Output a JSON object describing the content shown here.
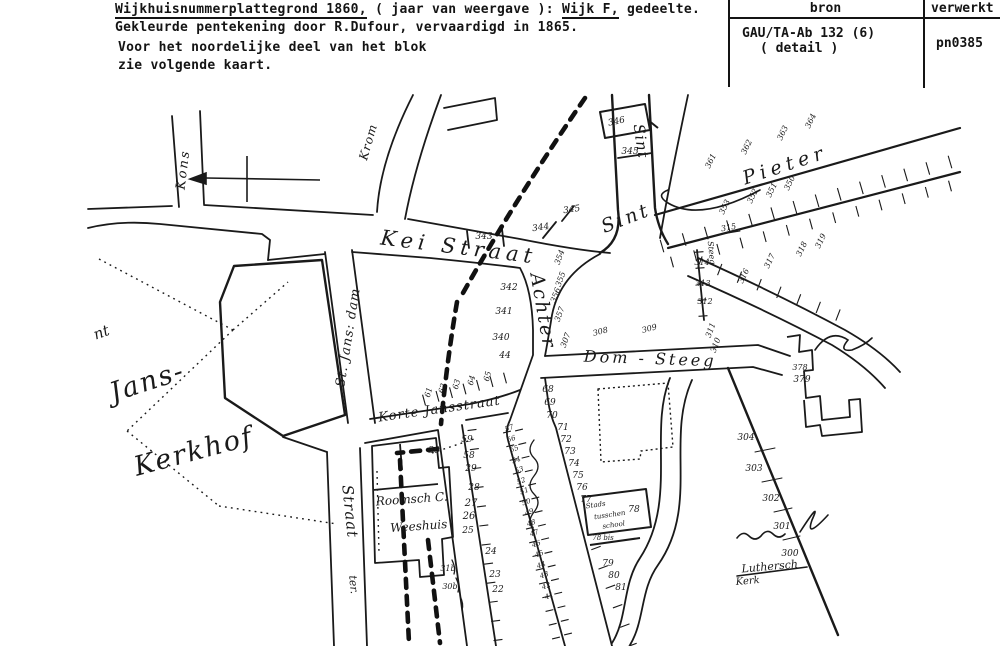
{
  "document": {
    "line1_part1": "Wijkhuisnummerplattegrond 1860,",
    "line1_part2": " ( jaar van weergave ): ",
    "line1_part3": "Wijk F,",
    "line1_part4": " gedeelte.",
    "line2": "Gekleurde pentekening door R.Dufour, vervaardigd in 1865.",
    "line3": "Voor het noordelijke deel van het blok",
    "line4": "zie volgende kaart.",
    "table": {
      "col1_header": "bron",
      "col2_header": "verwerkt",
      "source_line1": "GAU/TA-Ab 132 (6)",
      "source_line2": "( detail )",
      "processed_code": "pn0385"
    }
  },
  "colors": {
    "ink": "#141414",
    "paper": "#ffffff"
  },
  "map": {
    "compass": {
      "points": "west"
    },
    "labels": [
      {
        "n": "street-label-kons",
        "t": "Kons",
        "x": 187,
        "y": 170,
        "r": -83,
        "s": 13,
        "sp": 2,
        "st": "script"
      },
      {
        "n": "street-label-krom",
        "t": "Krom",
        "x": 372,
        "y": 143,
        "r": -74,
        "s": 12,
        "sp": 1,
        "st": "script"
      },
      {
        "n": "street-label-kei-straat",
        "t": "Kei Straat",
        "x": 458,
        "y": 254,
        "r": 7,
        "s": 21,
        "sp": 5,
        "st": "script"
      },
      {
        "n": "street-label-achter",
        "t": "Achter",
        "x": 537,
        "y": 312,
        "r": 80,
        "s": 19,
        "sp": 2,
        "st": "script"
      },
      {
        "n": "street-label-sint",
        "t": "Sint",
        "x": 628,
        "y": 224,
        "r": -21,
        "s": 19,
        "sp": 3,
        "st": "script"
      },
      {
        "n": "street-label-pieter",
        "t": "Pieter",
        "x": 787,
        "y": 171,
        "r": -18,
        "s": 19,
        "sp": 5,
        "st": "script"
      },
      {
        "n": "street-label-sint-vertical",
        "t": "Sint",
        "x": 636,
        "y": 142,
        "r": 82,
        "s": 15,
        "sp": 1,
        "st": "script"
      },
      {
        "n": "street-label-dom-steeg",
        "t": "Dom - Steeg",
        "x": 650,
        "y": 364,
        "r": 2,
        "s": 16,
        "sp": 3,
        "st": "script"
      },
      {
        "n": "street-label-st-jans-dam",
        "t": "St. Jans: dam",
        "x": 352,
        "y": 338,
        "r": -81,
        "s": 13,
        "sp": 1,
        "st": "script"
      },
      {
        "n": "street-label-korte-jansstraat",
        "t": "Korte Jansstraat",
        "x": 440,
        "y": 413,
        "r": -8,
        "s": 13,
        "sp": 1,
        "st": "script"
      },
      {
        "n": "place-label-jans",
        "t": "Jans-",
        "x": 150,
        "y": 390,
        "r": -18,
        "s": 27,
        "sp": 2,
        "st": "script"
      },
      {
        "n": "place-label-kerkhof",
        "t": "Kerkhof",
        "x": 196,
        "y": 460,
        "r": -15,
        "s": 27,
        "sp": 2,
        "st": "script"
      },
      {
        "n": "place-label-fragment-nt",
        "t": "nt",
        "x": 103,
        "y": 337,
        "r": -20,
        "s": 15,
        "st": "script"
      },
      {
        "n": "street-label-straat-vertical",
        "t": "Straat",
        "x": 345,
        "y": 512,
        "r": 84,
        "s": 15,
        "sp": 1,
        "st": "script"
      },
      {
        "n": "street-label-ter",
        "t": "ter.",
        "x": 350,
        "y": 585,
        "r": 84,
        "s": 11,
        "st": "script"
      },
      {
        "n": "street-label-steeg-small",
        "t": "Steeg",
        "x": 709,
        "y": 253,
        "r": 84,
        "s": 8,
        "st": "script"
      },
      {
        "n": "place-label-roomsch-c",
        "t": "Roomsch C.",
        "x": 412,
        "y": 503,
        "r": -4,
        "s": 12,
        "st": "script"
      },
      {
        "n": "place-label-weeshuis",
        "t": "Weeshuis",
        "x": 419,
        "y": 530,
        "r": -4,
        "s": 12,
        "st": "script"
      },
      {
        "n": "place-label-stads",
        "t": "Stads",
        "x": 596,
        "y": 507,
        "r": -8,
        "s": 7,
        "st": "script"
      },
      {
        "n": "place-label-tusschen",
        "t": "tusschen",
        "x": 610,
        "y": 517,
        "r": -8,
        "s": 7,
        "st": "script"
      },
      {
        "n": "place-label-school",
        "t": "school",
        "x": 614,
        "y": 527,
        "r": -8,
        "s": 7,
        "st": "script"
      },
      {
        "n": "place-label-luthersch",
        "t": "Luthersch",
        "x": 770,
        "y": 570,
        "r": -5,
        "s": 11,
        "st": "script"
      },
      {
        "n": "place-label-kerk",
        "t": "Kerk",
        "x": 748,
        "y": 584,
        "r": -5,
        "s": 10,
        "st": "script"
      },
      {
        "n": "plot-number",
        "t": "346",
        "x": 617,
        "y": 124,
        "r": -12
      },
      {
        "n": "plot-number",
        "t": "345",
        "x": 630,
        "y": 154
      },
      {
        "n": "plot-number",
        "t": "345",
        "x": 572,
        "y": 212,
        "r": -8
      },
      {
        "n": "plot-number",
        "t": "344",
        "x": 541,
        "y": 230,
        "r": -8
      },
      {
        "n": "plot-number",
        "t": "343",
        "x": 484,
        "y": 239
      },
      {
        "n": "plot-number",
        "t": "342",
        "x": 509,
        "y": 290
      },
      {
        "n": "plot-number",
        "t": "341",
        "x": 504,
        "y": 314
      },
      {
        "n": "plot-number",
        "t": "340",
        "x": 501,
        "y": 340
      },
      {
        "n": "plot-number",
        "t": "44",
        "x": 505,
        "y": 358
      },
      {
        "n": "plot-number",
        "t": "354",
        "x": 562,
        "y": 258,
        "r": -70,
        "s": 8
      },
      {
        "n": "plot-number",
        "t": "355",
        "x": 563,
        "y": 280,
        "r": -70,
        "s": 8
      },
      {
        "n": "plot-number",
        "t": "356",
        "x": 558,
        "y": 296,
        "r": -70,
        "s": 8
      },
      {
        "n": "plot-number",
        "t": "357",
        "x": 562,
        "y": 315,
        "r": -70,
        "s": 8
      },
      {
        "n": "plot-number",
        "t": "307",
        "x": 568,
        "y": 341,
        "r": -70,
        "s": 8
      },
      {
        "n": "plot-number",
        "t": "308",
        "x": 601,
        "y": 334,
        "r": -15,
        "s": 8
      },
      {
        "n": "plot-number",
        "t": "309",
        "x": 650,
        "y": 331,
        "r": -15,
        "s": 8
      },
      {
        "n": "plot-number",
        "t": "311",
        "x": 713,
        "y": 331,
        "r": -70,
        "s": 8
      },
      {
        "n": "plot-number",
        "t": "310",
        "x": 718,
        "y": 346,
        "r": -70,
        "s": 8
      },
      {
        "n": "plot-number",
        "t": "314",
        "x": 702,
        "y": 265,
        "s": 8
      },
      {
        "n": "plot-number",
        "t": "313",
        "x": 703,
        "y": 286,
        "s": 8
      },
      {
        "n": "plot-number",
        "t": "312",
        "x": 705,
        "y": 304,
        "s": 8
      },
      {
        "n": "plot-number",
        "t": "361",
        "x": 713,
        "y": 162,
        "r": -65,
        "s": 8
      },
      {
        "n": "plot-number",
        "t": "362",
        "x": 749,
        "y": 148,
        "r": -65,
        "s": 8
      },
      {
        "n": "plot-number",
        "t": "363",
        "x": 785,
        "y": 134,
        "r": -65,
        "s": 8
      },
      {
        "n": "plot-number",
        "t": "364",
        "x": 813,
        "y": 122,
        "r": -65,
        "s": 8
      },
      {
        "n": "plot-number",
        "t": "353",
        "x": 727,
        "y": 208,
        "r": -65,
        "s": 8
      },
      {
        "n": "plot-number",
        "t": "352",
        "x": 755,
        "y": 197,
        "r": -65,
        "s": 8
      },
      {
        "n": "plot-number",
        "t": "351",
        "x": 774,
        "y": 191,
        "r": -65,
        "s": 8
      },
      {
        "n": "plot-number",
        "t": "350",
        "x": 792,
        "y": 184,
        "r": -65,
        "s": 8
      },
      {
        "n": "plot-number",
        "t": "315",
        "x": 729,
        "y": 230,
        "r": -10,
        "s": 8
      },
      {
        "n": "plot-number",
        "t": "316",
        "x": 746,
        "y": 277,
        "r": -65,
        "s": 8
      },
      {
        "n": "plot-number",
        "t": "317",
        "x": 772,
        "y": 262,
        "r": -65,
        "s": 8
      },
      {
        "n": "plot-number",
        "t": "318",
        "x": 804,
        "y": 250,
        "r": -65,
        "s": 8
      },
      {
        "n": "plot-number",
        "t": "319",
        "x": 823,
        "y": 242,
        "r": -65,
        "s": 8
      },
      {
        "n": "plot-number",
        "t": "61",
        "x": 431,
        "y": 393,
        "r": -75,
        "s": 8
      },
      {
        "n": "plot-number",
        "t": "62",
        "x": 445,
        "y": 389,
        "r": -75,
        "s": 8
      },
      {
        "n": "plot-number",
        "t": "63",
        "x": 459,
        "y": 385,
        "r": -75,
        "s": 8
      },
      {
        "n": "plot-number",
        "t": "64",
        "x": 474,
        "y": 381,
        "r": -75,
        "s": 8
      },
      {
        "n": "plot-number",
        "t": "65",
        "x": 490,
        "y": 377,
        "r": -75,
        "s": 8
      },
      {
        "n": "plot-number",
        "t": "59",
        "x": 467,
        "y": 442
      },
      {
        "n": "plot-number",
        "t": "58",
        "x": 469,
        "y": 458
      },
      {
        "n": "plot-number",
        "t": "29",
        "x": 471,
        "y": 471
      },
      {
        "n": "plot-number",
        "t": "28",
        "x": 474,
        "y": 490
      },
      {
        "n": "plot-number",
        "t": "27",
        "x": 471,
        "y": 506,
        "s": 10
      },
      {
        "n": "plot-number",
        "t": "26",
        "x": 469,
        "y": 519,
        "s": 10
      },
      {
        "n": "plot-number",
        "t": "25",
        "x": 468,
        "y": 533
      },
      {
        "n": "plot-number",
        "t": "24",
        "x": 491,
        "y": 554
      },
      {
        "n": "plot-number",
        "t": "23",
        "x": 495,
        "y": 577
      },
      {
        "n": "plot-number",
        "t": "22",
        "x": 498,
        "y": 592
      },
      {
        "n": "plot-number",
        "t": "30",
        "x": 434,
        "y": 453
      },
      {
        "n": "plot-number",
        "t": "31b",
        "x": 448,
        "y": 571,
        "s": 8
      },
      {
        "n": "plot-number",
        "t": "30b",
        "x": 450,
        "y": 589,
        "s": 8
      },
      {
        "n": "plot-number",
        "t": "57",
        "x": 510,
        "y": 430,
        "r": -20,
        "s": 7
      },
      {
        "n": "plot-number",
        "t": "56",
        "x": 512,
        "y": 441,
        "r": -20,
        "s": 7
      },
      {
        "n": "plot-number",
        "t": "55",
        "x": 515,
        "y": 451,
        "r": -20,
        "s": 7
      },
      {
        "n": "plot-number",
        "t": "54",
        "x": 517,
        "y": 462,
        "r": -20,
        "s": 7
      },
      {
        "n": "plot-number",
        "t": "53",
        "x": 520,
        "y": 472,
        "r": -20,
        "s": 7
      },
      {
        "n": "plot-number",
        "t": "52",
        "x": 522,
        "y": 483,
        "r": -20,
        "s": 7
      },
      {
        "n": "plot-number",
        "t": "51",
        "x": 525,
        "y": 493,
        "r": -20,
        "s": 7
      },
      {
        "n": "plot-number",
        "t": "50",
        "x": 527,
        "y": 504,
        "r": -20,
        "s": 7
      },
      {
        "n": "plot-number",
        "t": "49",
        "x": 530,
        "y": 514,
        "r": -20,
        "s": 7
      },
      {
        "n": "plot-number",
        "t": "48",
        "x": 532,
        "y": 525,
        "r": -20,
        "s": 7
      },
      {
        "n": "plot-number",
        "t": "47",
        "x": 535,
        "y": 535,
        "r": -20,
        "s": 7
      },
      {
        "n": "plot-number",
        "t": "46",
        "x": 537,
        "y": 546,
        "r": -20,
        "s": 7
      },
      {
        "n": "plot-number",
        "t": "45",
        "x": 540,
        "y": 556,
        "r": -20,
        "s": 7
      },
      {
        "n": "plot-number",
        "t": "44",
        "x": 542,
        "y": 567,
        "r": -20,
        "s": 7
      },
      {
        "n": "plot-number",
        "t": "43",
        "x": 545,
        "y": 577,
        "r": -20,
        "s": 7
      },
      {
        "n": "plot-number",
        "t": "42",
        "x": 547,
        "y": 588,
        "r": -20,
        "s": 7
      },
      {
        "n": "plot-number",
        "t": "41",
        "x": 550,
        "y": 598,
        "r": -20,
        "s": 7
      },
      {
        "n": "plot-number",
        "t": "68",
        "x": 548,
        "y": 392
      },
      {
        "n": "plot-number",
        "t": "69",
        "x": 550,
        "y": 405
      },
      {
        "n": "plot-number",
        "t": "70",
        "x": 552,
        "y": 418
      },
      {
        "n": "plot-number",
        "t": "71",
        "x": 563,
        "y": 430
      },
      {
        "n": "plot-number",
        "t": "72",
        "x": 566,
        "y": 442
      },
      {
        "n": "plot-number",
        "t": "73",
        "x": 570,
        "y": 454
      },
      {
        "n": "plot-number",
        "t": "74",
        "x": 574,
        "y": 466
      },
      {
        "n": "plot-number",
        "t": "75",
        "x": 578,
        "y": 478
      },
      {
        "n": "plot-number",
        "t": "76",
        "x": 582,
        "y": 490
      },
      {
        "n": "plot-number",
        "t": "77",
        "x": 586,
        "y": 502
      },
      {
        "n": "plot-number",
        "t": "78",
        "x": 634,
        "y": 512
      },
      {
        "n": "plot-number",
        "t": "78 bis",
        "x": 603,
        "y": 540,
        "s": 7
      },
      {
        "n": "plot-number",
        "t": "79",
        "x": 608,
        "y": 566
      },
      {
        "n": "plot-number",
        "t": "80",
        "x": 614,
        "y": 578
      },
      {
        "n": "plot-number",
        "t": "81",
        "x": 621,
        "y": 590
      },
      {
        "n": "plot-number",
        "t": "304",
        "x": 746,
        "y": 440
      },
      {
        "n": "plot-number",
        "t": "303",
        "x": 754,
        "y": 471
      },
      {
        "n": "plot-number",
        "t": "302",
        "x": 771,
        "y": 501
      },
      {
        "n": "plot-number",
        "t": "301",
        "x": 782,
        "y": 529
      },
      {
        "n": "plot-number",
        "t": "300",
        "x": 790,
        "y": 556
      },
      {
        "n": "plot-number",
        "t": "378",
        "x": 800,
        "y": 370,
        "s": 8
      },
      {
        "n": "plot-number",
        "t": "379",
        "x": 802,
        "y": 382
      }
    ]
  }
}
